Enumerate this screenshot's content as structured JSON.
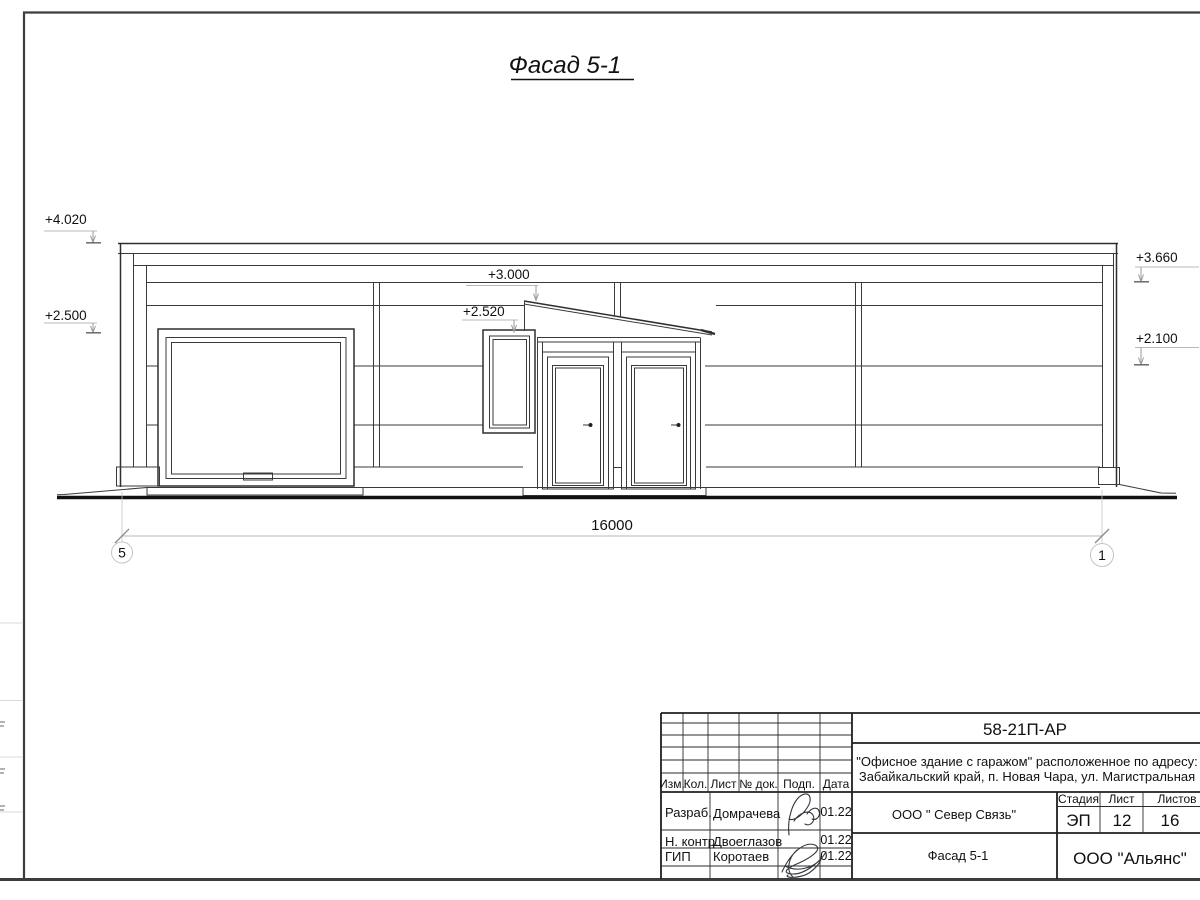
{
  "drawing_title": "Фасад 5-1",
  "facade": {
    "marks": {
      "m4020": "+4.020",
      "m2500": "+2.500",
      "m3000": "+3.000",
      "m2520": "+2.520",
      "m3660": "+3.660",
      "m2100": "+2.100"
    },
    "dimension_total": "16000",
    "axes": {
      "left": "5",
      "right": "1"
    }
  },
  "title_block": {
    "doc_code": "58-21П-АР",
    "project_address_line1": "\"Офисное здание с гаражом\" расположенное по адресу:",
    "project_address_line2": "Забайкальский край, п. Новая Чара, ул. Магистральная",
    "columns": {
      "izm": "Изм.",
      "kol": "Кол.",
      "list": "Лист",
      "doc": "№ док.",
      "podp": "Подп.",
      "data": "Дата"
    },
    "stage_header": {
      "stage": "Стадия",
      "sheet": "Лист",
      "sheets": "Листов"
    },
    "stage_values": {
      "stage": "ЭП",
      "sheet": "12",
      "sheets": "16"
    },
    "signature_rows": [
      {
        "role": "Разраб.",
        "name": "Домрачева",
        "date": "01.22"
      },
      {
        "role": "Н. контр.",
        "name": "Двоеглазов",
        "date": "01.22"
      },
      {
        "role": "ГИП",
        "name": "Коротаев",
        "date": "01.22"
      }
    ],
    "contractor": "ООО \" Север Связь\"",
    "sheet_title": "Фасад 5-1",
    "organization": "ООО \"Альянс\""
  },
  "colors": {
    "line": "#3a3a3a",
    "leader": "#b8b8b8",
    "paper": "#ffffff"
  }
}
